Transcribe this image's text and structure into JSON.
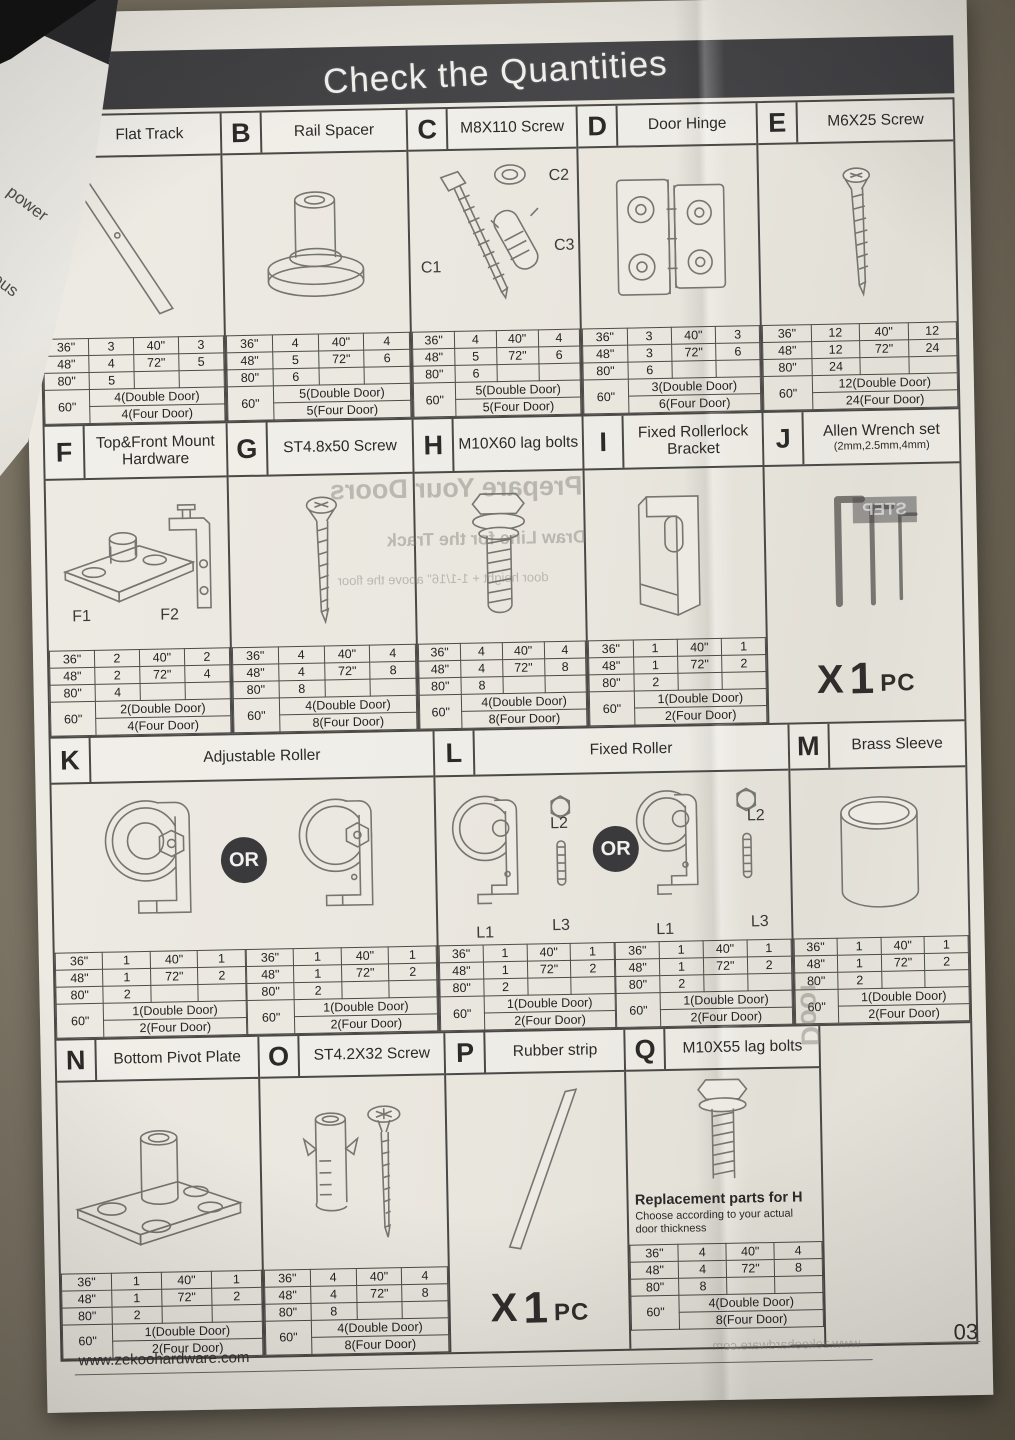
{
  "title": "Check the Quantities",
  "or_label": "OR",
  "one_pc": {
    "x": "X",
    "num": "1",
    "unit": "PC"
  },
  "sizes": {
    "s36": "36\"",
    "s40": "40\"",
    "s48": "48\"",
    "s72": "72\"",
    "s80": "80\"",
    "s60": "60\""
  },
  "sections": {
    "a": {
      "letter": "A",
      "name": "Flat Track",
      "qty": {
        "v36": "3",
        "v40": "3",
        "v48": "4",
        "v72": "5",
        "v80": "5",
        "double": "4(Double Door)",
        "four": "4(Four Door)"
      }
    },
    "b": {
      "letter": "B",
      "name": "Rail Spacer",
      "qty": {
        "v36": "4",
        "v40": "4",
        "v48": "5",
        "v72": "6",
        "v80": "6",
        "double": "5(Double Door)",
        "four": "5(Four Door)"
      }
    },
    "c": {
      "letter": "C",
      "name": "M8X110 Screw",
      "labels": {
        "c1": "C1",
        "c2": "C2",
        "c3": "C3"
      },
      "qty": {
        "v36": "4",
        "v40": "4",
        "v48": "5",
        "v72": "6",
        "v80": "6",
        "double": "5(Double Door)",
        "four": "5(Four Door)"
      }
    },
    "d": {
      "letter": "D",
      "name": "Door Hinge",
      "qty": {
        "v36": "3",
        "v40": "3",
        "v48": "3",
        "v72": "6",
        "v80": "6",
        "double": "3(Double Door)",
        "four": "6(Four Door)"
      }
    },
    "e": {
      "letter": "E",
      "name": "M6X25 Screw",
      "qty": {
        "v36": "12",
        "v40": "12",
        "v48": "12",
        "v72": "24",
        "v80": "24",
        "double": "12(Double Door)",
        "four": "24(Four Door)"
      }
    },
    "f": {
      "letter": "F",
      "name": "Top&Front Mount Hardware",
      "labels": {
        "f1": "F1",
        "f2": "F2"
      },
      "qty": {
        "v36": "2",
        "v40": "2",
        "v48": "2",
        "v72": "4",
        "v80": "4",
        "double": "2(Double Door)",
        "four": "4(Four Door)"
      }
    },
    "g": {
      "letter": "G",
      "name": "ST4.8x50 Screw",
      "qty": {
        "v36": "4",
        "v40": "4",
        "v48": "4",
        "v72": "8",
        "v80": "8",
        "double": "4(Double Door)",
        "four": "8(Four Door)"
      }
    },
    "h": {
      "letter": "H",
      "name": "M10X60 lag bolts",
      "qty": {
        "v36": "4",
        "v40": "4",
        "v48": "4",
        "v72": "8",
        "v80": "8",
        "double": "4(Double Door)",
        "four": "8(Four Door)"
      }
    },
    "i": {
      "letter": "I",
      "name": "Fixed Rollerlock Bracket",
      "qty": {
        "v36": "1",
        "v40": "1",
        "v48": "1",
        "v72": "2",
        "v80": "2",
        "double": "1(Double Door)",
        "four": "2(Four Door)"
      }
    },
    "j": {
      "letter": "J",
      "name": "Allen Wrench set",
      "subname": "(2mm,2.5mm,4mm)"
    },
    "k": {
      "letter": "K",
      "name": "Adjustable Roller",
      "qty": {
        "v36": "1",
        "v40": "1",
        "v48": "1",
        "v72": "2",
        "v80": "2",
        "double": "1(Double Door)",
        "four": "2(Four Door)"
      },
      "qty2": {
        "v36": "1",
        "v40": "1",
        "v48": "1",
        "v72": "2",
        "v80": "2",
        "double": "1(Double Door)",
        "four": "2(Four Door)"
      }
    },
    "l": {
      "letter": "L",
      "name": "Fixed Roller",
      "labels": {
        "l1": "L1",
        "l2": "L2",
        "l3": "L3"
      },
      "qty": {
        "v36": "1",
        "v40": "1",
        "v48": "1",
        "v72": "2",
        "v80": "2",
        "double": "1(Double Door)",
        "four": "2(Four Door)"
      },
      "qty2": {
        "v36": "1",
        "v40": "1",
        "v48": "1",
        "v72": "2",
        "v80": "2",
        "double": "1(Double Door)",
        "four": "2(Four Door)"
      }
    },
    "m": {
      "letter": "M",
      "name": "Brass Sleeve",
      "qty": {
        "v36": "1",
        "v40": "1",
        "v48": "1",
        "v72": "2",
        "v80": "2",
        "double": "1(Double Door)",
        "four": "2(Four Door)"
      }
    },
    "n": {
      "letter": "N",
      "name": "Bottom Pivot Plate",
      "qty": {
        "v36": "1",
        "v40": "1",
        "v48": "1",
        "v72": "2",
        "v80": "2",
        "double": "1(Double Door)",
        "four": "2(Four Door)"
      }
    },
    "o": {
      "letter": "O",
      "name": "ST4.2X32 Screw",
      "qty": {
        "v36": "4",
        "v40": "4",
        "v48": "4",
        "v72": "8",
        "v80": "8",
        "double": "4(Double Door)",
        "four": "8(Four Door)"
      }
    },
    "p": {
      "letter": "P",
      "name": "Rubber strip"
    },
    "q": {
      "letter": "Q",
      "name": "M10X55 lag bolts",
      "note_title": "Replacement parts for H",
      "note_body": "Choose according to your actual door thickness",
      "qty": {
        "v36": "4",
        "v40": "4",
        "v48": "4",
        "v72": "8",
        "v80": "8",
        "double": "4(Double Door)",
        "four": "8(Four Door)"
      }
    }
  },
  "bleedthrough": {
    "doors_heading": "Prepare Your Doors",
    "step_label": "STEP",
    "line1": "Draw Line for the Track",
    "line2": "door height + 1-1/16\" above the floor",
    "door_vertical": "Door",
    "url_mirror": "www.zekoohardware.com"
  },
  "torn_corner": {
    "word1": "power",
    "word2": "ious"
  },
  "footer": {
    "url": "www.zekoohardware.com",
    "page": "03"
  }
}
